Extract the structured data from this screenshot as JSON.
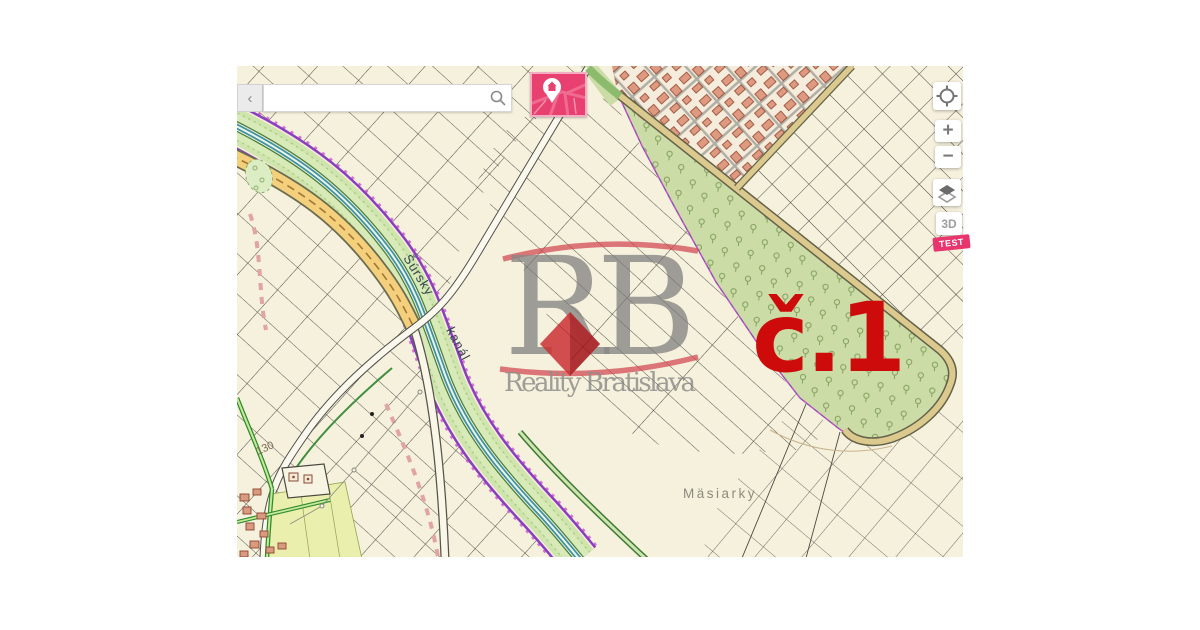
{
  "search": {
    "back_chevron": "‹",
    "placeholder": "",
    "value": ""
  },
  "controls": {
    "zoom_in": "+",
    "zoom_out": "−",
    "threed_label": "3D",
    "test_badge": "TEST"
  },
  "annotation": {
    "parcel_label": "č.1",
    "color": "#ce0b0b"
  },
  "watermark": {
    "initials": "RB",
    "company": "Reality Bratislava"
  },
  "map_labels": {
    "canal_word1": "Šúrsky",
    "canal_word2": "kanál",
    "area_name": "Mäsiarky",
    "road_number": "130"
  },
  "colors": {
    "map_background": "#f6f1dd",
    "parcel_line": "#4a4a40",
    "orchard_fill": "#ccdca6",
    "canal_water": "#3c93a6",
    "canal_vegetation": "#cfe5ad",
    "boundary_purple": "#8b3fc0",
    "road_tan": "#dcc98d",
    "road_orange": "#f4d07c",
    "village_building": "#dd9a80",
    "brand_pink": "#e8406f",
    "annotation_red": "#ce0b0b"
  }
}
